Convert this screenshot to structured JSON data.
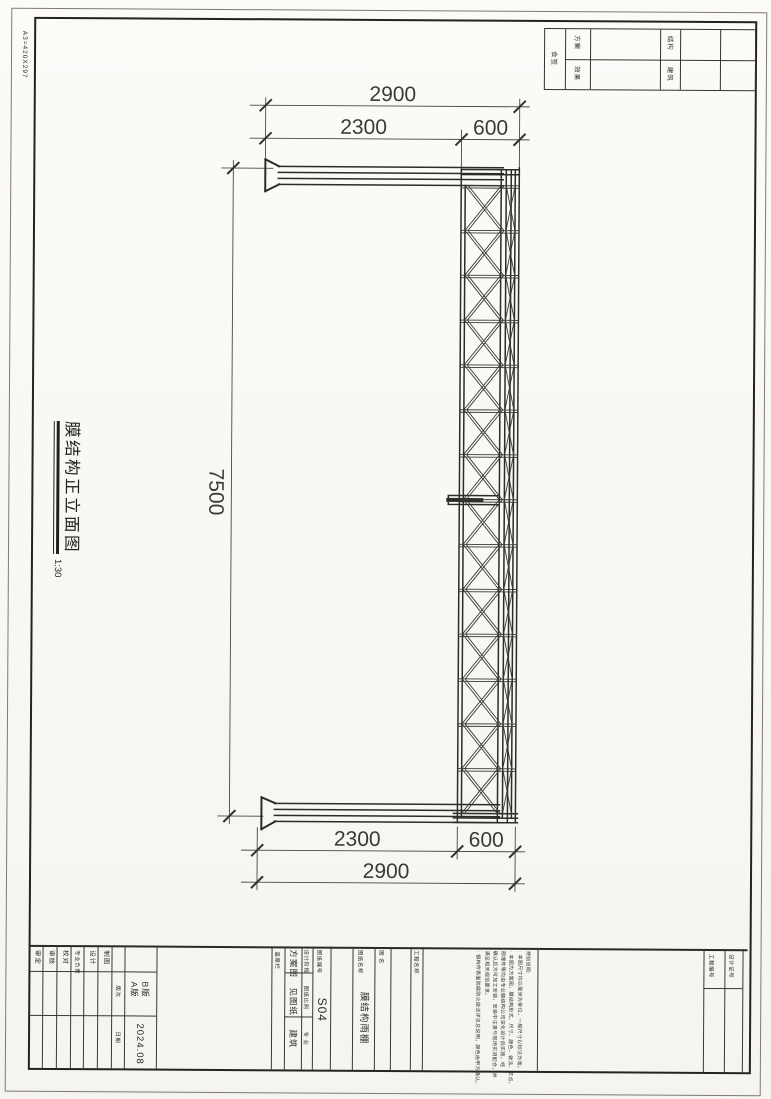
{
  "margin_label": "A3=420X297",
  "signoff": {
    "corner_label": "会签",
    "col1": {
      "top": "方案",
      "bottom": "效果"
    },
    "col2": {
      "top": "结构",
      "bottom": "建筑"
    }
  },
  "elevation": {
    "title": "膜结构正立面图",
    "scale": "1:30",
    "dim_top_overall": "2900",
    "dim_top_main": "2300",
    "dim_top_cantilever": "600",
    "dim_height": "7500",
    "dim_bottom_main": "2300",
    "dim_bottom_cantilever": "600",
    "dim_bottom_overall": "2900"
  },
  "title_block": {
    "approver_label": "审定",
    "checker_label": "审核",
    "proof_label": "校对",
    "lead_label": "专业负责",
    "designer_label": "设计",
    "drafter_label": "制图",
    "version_label": "版次",
    "versions": [
      "A版",
      "B版"
    ],
    "date_label": "日期",
    "date": "2024.08",
    "stamp_label": "盖章栏",
    "stage_label": "设计阶段",
    "stage": "方案图",
    "scale_label": "图纸比例",
    "scale": "见图纸",
    "discipline_label": "专 业",
    "discipline": "建筑",
    "sheet_no_label": "图纸编号",
    "sheet_no": "S04",
    "sheet_name_label": "图纸名称",
    "sheet_name": "膜结构雨棚",
    "name_label": "图 名",
    "project_label": "工程名称",
    "project_no_label": "工程编号",
    "cert_label": "设计证号",
    "notes_title": "特别说明:",
    "notes": [
      "· 本图尺寸均以毫米为单位，一般尺寸以标注为准。",
      "· 本图为方案图，膜结构形式、尺寸、颜色、做法、节点、",
      "  预埋件等均由专业膜结构公司深化设计后实施，经",
      "  确认后方可加工安装，安装中注意与现场实测配合，并",
      "  满足相关规范要求。",
      "· 钢构件表面防腐防火做法详见总说明，颜色由甲方确认。"
    ]
  }
}
